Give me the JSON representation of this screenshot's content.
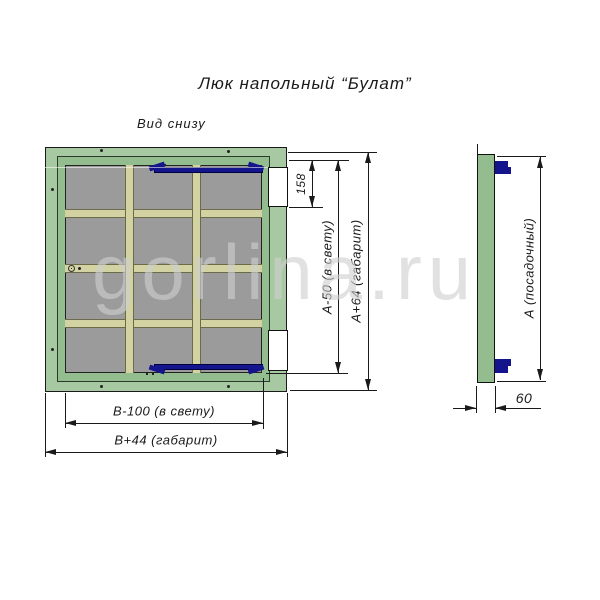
{
  "title": "Люк напольный “Булат”",
  "view_label": "Вид снизу",
  "watermark": "gorlina.ru",
  "dimensions": {
    "d158": "158",
    "a_clear": "А-50 (в свету)",
    "a_overall": "А+64 (габарит)",
    "b_clear": "В-100 (в свету)",
    "b_overall": "В+44 (габарит)",
    "a_seat": "А (посадочный)",
    "thickness": "60"
  },
  "colors": {
    "frame_green": "#a7c9a1",
    "lid_green": "#93bd8f",
    "panel_gray": "#9b9b9b",
    "rib_khaki": "#d2d2a2",
    "latch_navy": "#14148c",
    "line": "#1a1a1a",
    "watermark_gray": "#d0d0d0"
  }
}
